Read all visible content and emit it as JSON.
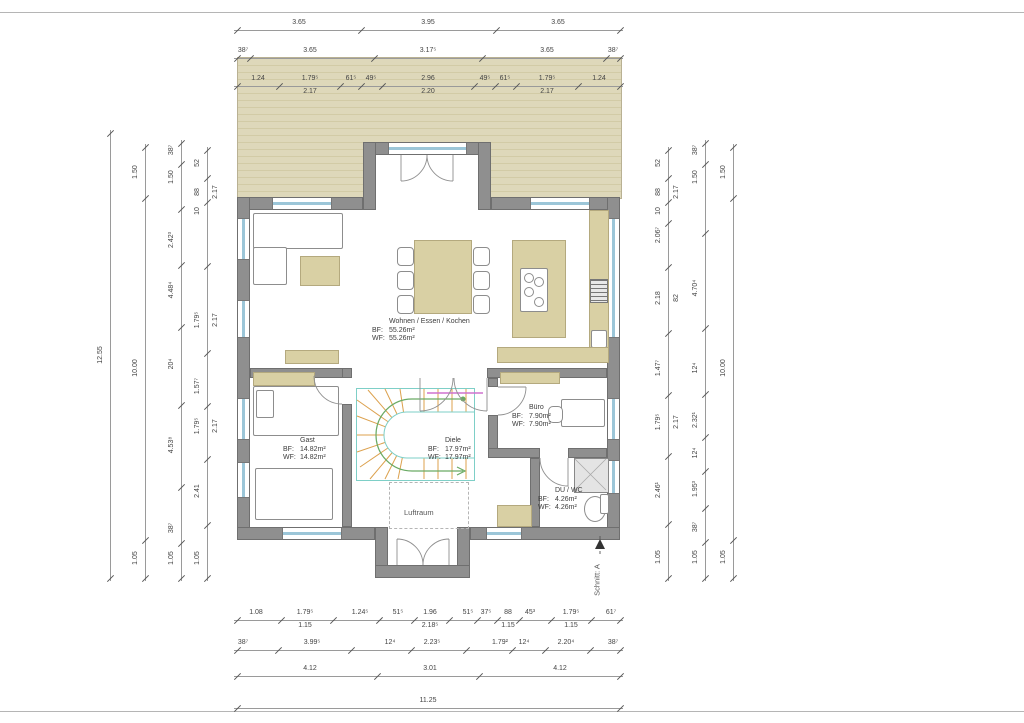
{
  "drawing": {
    "type": "floor-plan",
    "labels": {
      "bf": "BF:",
      "wf": "WF:"
    },
    "rooms": {
      "wohnen": {
        "name": "Wohnen / Essen / Kochen",
        "bf": "55.26m²",
        "wf": "55.26m²"
      },
      "gast": {
        "name": "Gast",
        "bf": "14.82m²",
        "wf": "14.82m²"
      },
      "diele": {
        "name": "Diele",
        "bf": "17.97m²",
        "wf": "17.97m²"
      },
      "buero": {
        "name": "Büro",
        "bf": "7.90m²",
        "wf": "7.90m²"
      },
      "duwc": {
        "name": "DU / WC",
        "bf": "4.26m²",
        "wf": "4.26m²"
      }
    },
    "annotations": {
      "luftraum": "Luftraum",
      "schnitt": "Schnitt: A"
    }
  },
  "colors": {
    "terrace": "#ded8ba",
    "wall": "#8f8f8f",
    "furniture": "#d9d0a4",
    "window_glass": "#9cc6d8",
    "stair_tread": "#dca14e",
    "stair_outline": "#7ecfc7",
    "walkline": "#6aaa64",
    "guardrail": "#cf72cf",
    "dimension_text": "#444444"
  },
  "dimensions": {
    "chains": [
      {
        "id": "top-1",
        "o": "h",
        "p": 30,
        "a": 237,
        "b": 620,
        "ticks": [
          237,
          361,
          496,
          620
        ],
        "labels": [
          {
            "at": 299,
            "t": "3.65"
          },
          {
            "at": 428,
            "t": "3.95"
          },
          {
            "at": 558,
            "t": "3.65"
          }
        ]
      },
      {
        "id": "top-2",
        "o": "h",
        "p": 58,
        "a": 237,
        "b": 620,
        "ticks": [
          237,
          250,
          374,
          482,
          606,
          620
        ],
        "labels": [
          {
            "at": 243,
            "t": "38⁷"
          },
          {
            "at": 310,
            "t": "3.65"
          },
          {
            "at": 428,
            "t": "3.17⁵"
          },
          {
            "at": 547,
            "t": "3.65"
          },
          {
            "at": 613,
            "t": "38⁷"
          }
        ]
      },
      {
        "id": "top-3",
        "o": "h",
        "p": 86,
        "a": 237,
        "b": 620,
        "ticks": [
          237,
          279,
          340,
          361,
          382,
          474,
          495,
          516,
          578,
          620
        ],
        "labels": [
          {
            "at": 258,
            "t": "1.24"
          },
          {
            "at": 310,
            "t": "1.79⁵"
          },
          {
            "at": 351,
            "t": "61⁵"
          },
          {
            "at": 371,
            "t": "49⁵"
          },
          {
            "at": 428,
            "t": "2.96"
          },
          {
            "at": 485,
            "t": "49⁵"
          },
          {
            "at": 505,
            "t": "61⁵"
          },
          {
            "at": 547,
            "t": "1.79⁵"
          },
          {
            "at": 599,
            "t": "1.24"
          }
        ],
        "sums": [
          {
            "at": 310,
            "t": "2.17"
          },
          {
            "at": 428,
            "t": "2.20"
          },
          {
            "at": 547,
            "t": "2.17"
          }
        ]
      },
      {
        "id": "bottom-1",
        "o": "h",
        "p": 620,
        "a": 237,
        "b": 620,
        "labels": [
          {
            "at": 256,
            "t": "1.08"
          },
          {
            "at": 305,
            "t": "1.79⁵"
          },
          {
            "at": 360,
            "t": "1.24⁵"
          },
          {
            "at": 398,
            "t": "51⁵"
          },
          {
            "at": 430,
            "t": "1.96"
          },
          {
            "at": 468,
            "t": "51⁵"
          },
          {
            "at": 486,
            "t": "37⁵"
          },
          {
            "at": 508,
            "t": "88"
          },
          {
            "at": 530,
            "t": "45³"
          },
          {
            "at": 571,
            "t": "1.79⁵"
          },
          {
            "at": 611,
            "t": "61⁷"
          }
        ],
        "sums": [
          {
            "at": 305,
            "t": "1.15"
          },
          {
            "at": 430,
            "t": "2.18⁵"
          },
          {
            "at": 508,
            "t": "1.15"
          },
          {
            "at": 571,
            "t": "1.15"
          }
        ]
      },
      {
        "id": "bottom-2",
        "o": "h",
        "p": 650,
        "a": 237,
        "b": 620,
        "labels": [
          {
            "at": 243,
            "t": "38⁷"
          },
          {
            "at": 312,
            "t": "3.99⁵"
          },
          {
            "at": 390,
            "t": "12⁴"
          },
          {
            "at": 432,
            "t": "2.23⁵"
          },
          {
            "at": 500,
            "t": "1.79²"
          },
          {
            "at": 524,
            "t": "12⁴"
          },
          {
            "at": 566,
            "t": "2.20⁴"
          },
          {
            "at": 613,
            "t": "38⁷"
          }
        ]
      },
      {
        "id": "bottom-3",
        "o": "h",
        "p": 676,
        "a": 237,
        "b": 620,
        "ticks": [
          237,
          377,
          479,
          620
        ],
        "labels": [
          {
            "at": 310,
            "t": "4.12"
          },
          {
            "at": 430,
            "t": "3.01"
          },
          {
            "at": 560,
            "t": "4.12"
          }
        ]
      },
      {
        "id": "bottom-4",
        "o": "h",
        "p": 708,
        "a": 237,
        "b": 620,
        "ticks": [
          237,
          620
        ],
        "labels": [
          {
            "at": 428,
            "t": "11.25"
          }
        ]
      },
      {
        "id": "left-1",
        "o": "v",
        "p": 110,
        "a": 133,
        "b": 578,
        "ticks": [
          133,
          578
        ],
        "labels": [
          {
            "at": 355,
            "t": "12.55"
          }
        ]
      },
      {
        "id": "left-2",
        "o": "v",
        "p": 145,
        "a": 147,
        "b": 578,
        "ticks": [
          147,
          198,
          540,
          578
        ],
        "labels": [
          {
            "at": 172,
            "t": "1.50"
          },
          {
            "at": 368,
            "t": "10.00"
          },
          {
            "at": 558,
            "t": "1.05"
          }
        ]
      },
      {
        "id": "left-3",
        "o": "v",
        "p": 181,
        "a": 143,
        "b": 578,
        "labels": [
          {
            "at": 150,
            "t": "38⁷"
          },
          {
            "at": 177,
            "t": "1.50"
          },
          {
            "at": 240,
            "t": "2.42³"
          },
          {
            "at": 290,
            "t": "4.48⁴"
          },
          {
            "at": 364,
            "t": "20⁴"
          },
          {
            "at": 445,
            "t": "4.53⁸"
          },
          {
            "at": 528,
            "t": "38⁷"
          },
          {
            "at": 558,
            "t": "1.05"
          }
        ]
      },
      {
        "id": "left-4",
        "o": "v",
        "p": 207,
        "a": 150,
        "b": 578,
        "labels": [
          {
            "at": 163,
            "t": "52"
          },
          {
            "at": 192,
            "t": "88"
          },
          {
            "at": 211,
            "t": "10"
          },
          {
            "at": 320,
            "t": "1.79⁵"
          },
          {
            "at": 386,
            "t": "1.57⁷"
          },
          {
            "at": 426,
            "t": "1.79⁵"
          },
          {
            "at": 491,
            "t": "2.41"
          },
          {
            "at": 558,
            "t": "1.05"
          }
        ],
        "sums": [
          {
            "at": 192,
            "t": "2.17"
          },
          {
            "at": 320,
            "t": "2.17"
          },
          {
            "at": 426,
            "t": "2.17"
          }
        ]
      },
      {
        "id": "right-1",
        "o": "v",
        "p": 668,
        "a": 150,
        "b": 578,
        "labels": [
          {
            "at": 163,
            "t": "52"
          },
          {
            "at": 192,
            "t": "88"
          },
          {
            "at": 211,
            "t": "10"
          },
          {
            "at": 235,
            "t": "2.06⁷"
          },
          {
            "at": 298,
            "t": "2.18"
          },
          {
            "at": 368,
            "t": "1.47⁷"
          },
          {
            "at": 422,
            "t": "1.79⁵"
          },
          {
            "at": 490,
            "t": "2.46¹"
          },
          {
            "at": 557,
            "t": "1.05"
          }
        ],
        "sums": [
          {
            "at": 192,
            "t": "2.17"
          },
          {
            "at": 298,
            "t": "82"
          },
          {
            "at": 422,
            "t": "2.17"
          }
        ]
      },
      {
        "id": "right-2",
        "o": "v",
        "p": 705,
        "a": 143,
        "b": 578,
        "labels": [
          {
            "at": 150,
            "t": "38⁷"
          },
          {
            "at": 177,
            "t": "1.50"
          },
          {
            "at": 288,
            "t": "4.70⁴"
          },
          {
            "at": 368,
            "t": "12⁴"
          },
          {
            "at": 420,
            "t": "2.32¹"
          },
          {
            "at": 453,
            "t": "12⁴"
          },
          {
            "at": 489,
            "t": "1.95³"
          },
          {
            "at": 527,
            "t": "38⁷"
          },
          {
            "at": 557,
            "t": "1.05"
          }
        ]
      },
      {
        "id": "right-3",
        "o": "v",
        "p": 733,
        "a": 147,
        "b": 578,
        "ticks": [
          147,
          198,
          540,
          578
        ],
        "labels": [
          {
            "at": 172,
            "t": "1.50"
          },
          {
            "at": 368,
            "t": "10.00"
          },
          {
            "at": 557,
            "t": "1.05"
          }
        ]
      }
    ]
  }
}
